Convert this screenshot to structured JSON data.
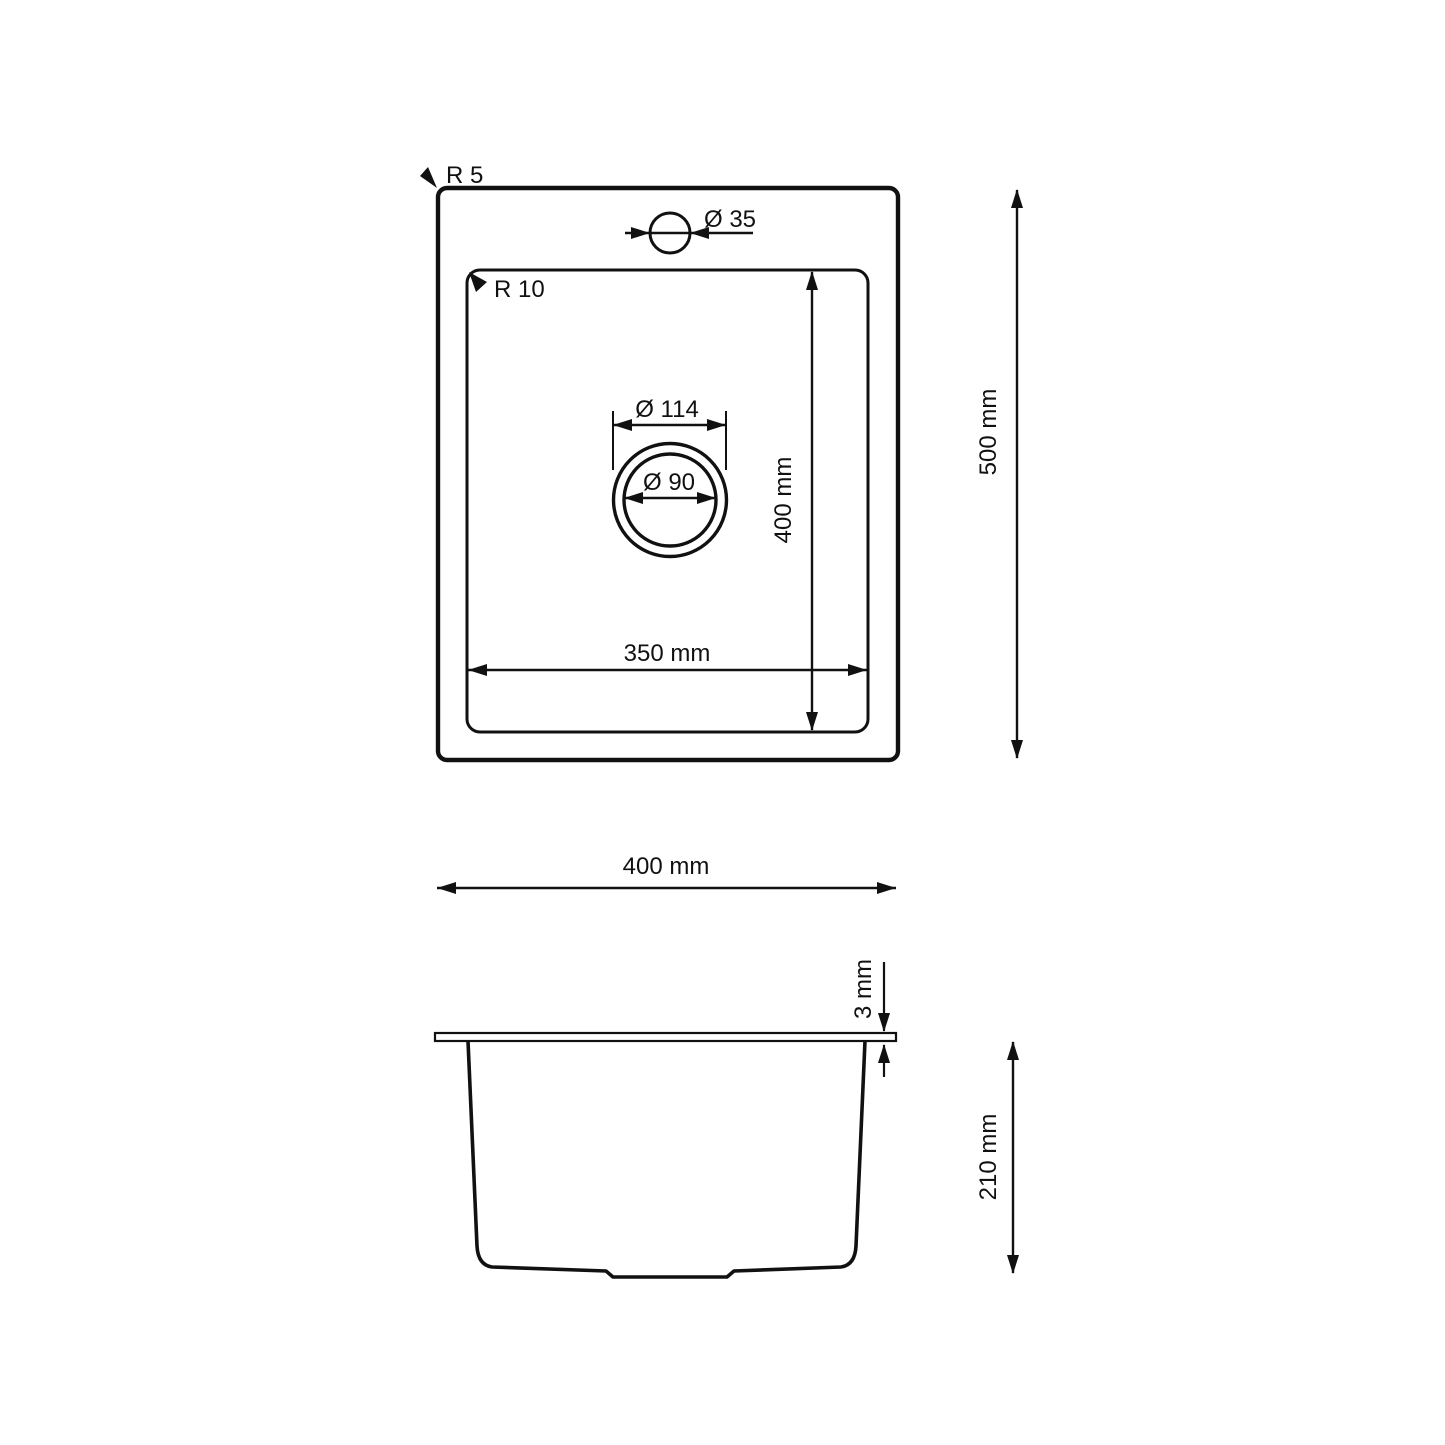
{
  "drawing": {
    "title": "sink-dimension-drawing",
    "colors": {
      "line": "#111111",
      "background": "#ffffff"
    },
    "labels": {
      "r5": "R 5",
      "r10": "R 10",
      "faucet_dia": "Ø 35",
      "drain_outer_dia": "Ø 114",
      "drain_inner_dia": "Ø 90",
      "bowl_width": "350 mm",
      "bowl_depth": "400 mm",
      "overall_depth": "500 mm",
      "overall_width": "400 mm",
      "rim_thickness": "3 mm",
      "bowl_height": "210 mm"
    },
    "dimensions_mm": {
      "outer_corner_radius": 5,
      "inner_corner_radius": 10,
      "faucet_hole_diameter": 35,
      "drain_outer_diameter": 114,
      "drain_diameter": 90,
      "bowl_width": 350,
      "bowl_depth": 400,
      "overall_depth": 500,
      "overall_width": 400,
      "rim_thickness": 3,
      "bowl_height": 210
    }
  }
}
